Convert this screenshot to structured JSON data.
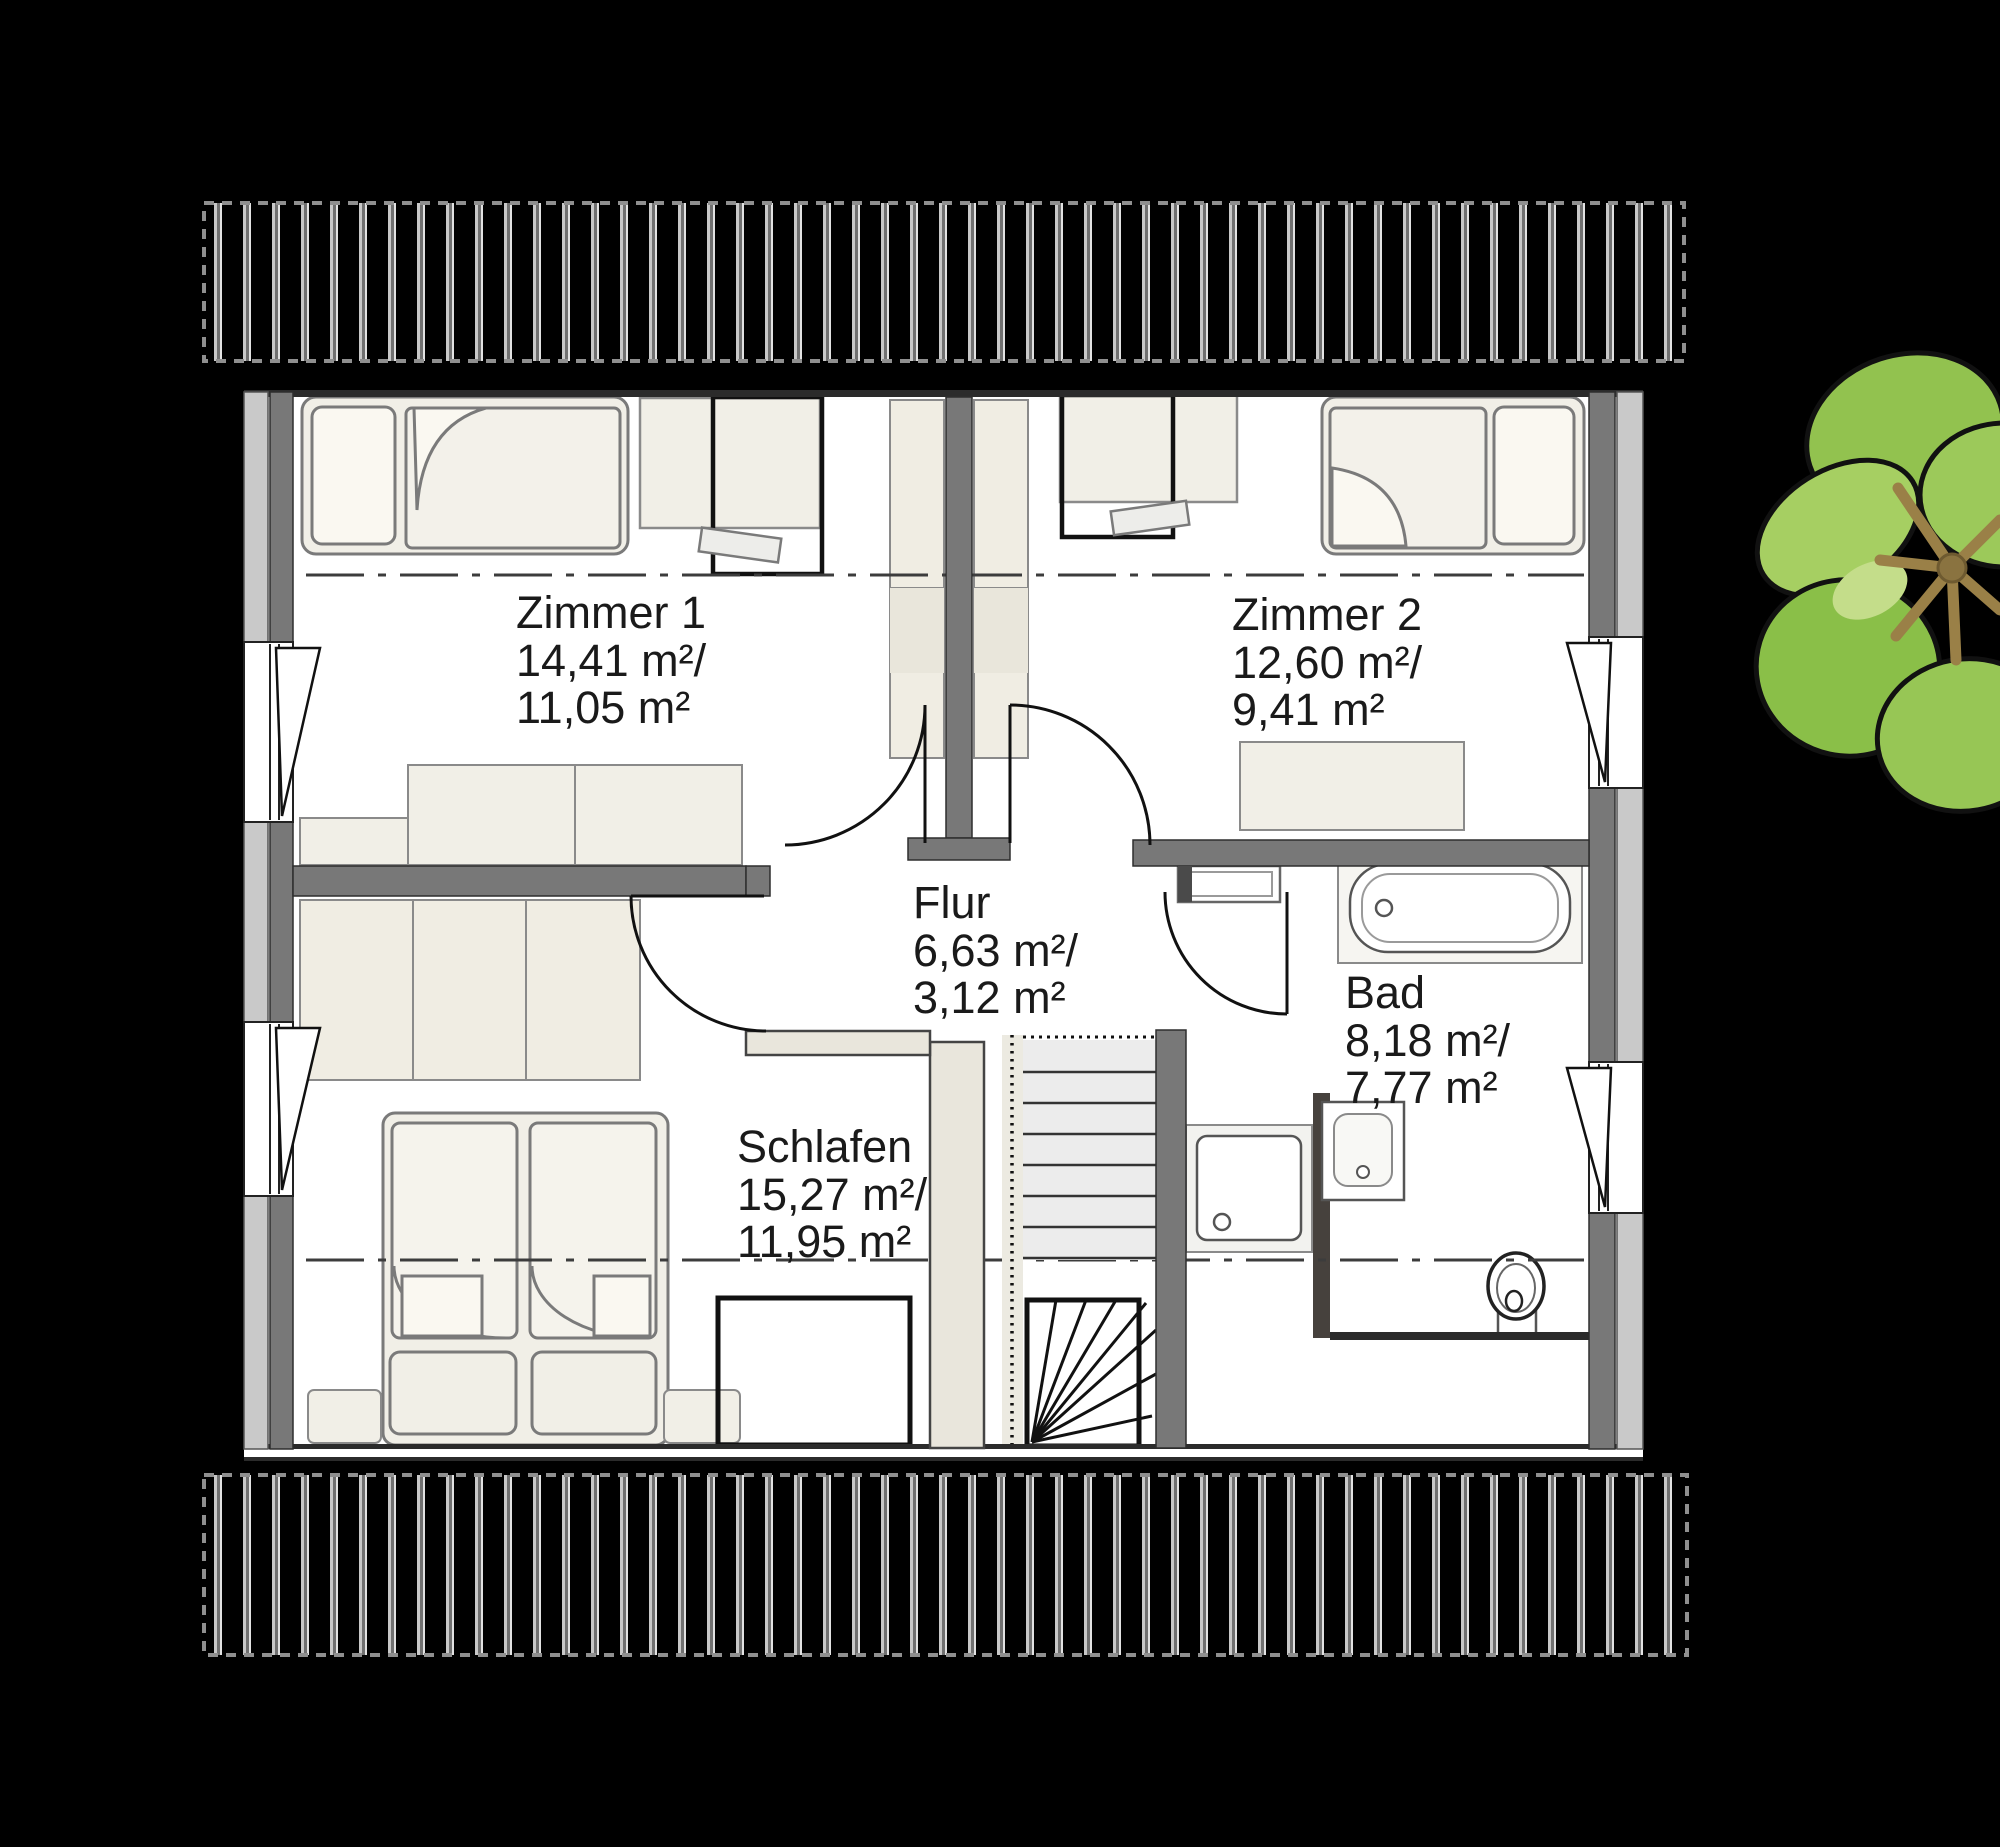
{
  "floorplan": {
    "rooms": [
      {
        "id": "zimmer1",
        "name": "Zimmer 1",
        "gross_area": "14,41 m²/",
        "living_area": "11,05 m²"
      },
      {
        "id": "zimmer2",
        "name": "Zimmer 2",
        "gross_area": "12,60 m²/",
        "living_area": "9,41 m²"
      },
      {
        "id": "flur",
        "name": "Flur",
        "gross_area": "6,63 m²/",
        "living_area": "3,12 m²"
      },
      {
        "id": "bad",
        "name": "Bad",
        "gross_area": "8,18 m²/",
        "living_area": "7,77 m²"
      },
      {
        "id": "schlafen",
        "name": "Schlafen",
        "gross_area": "15,27 m²/",
        "living_area": "11,95 m²"
      }
    ],
    "colors": {
      "background": "#000000",
      "floor": "#ffffff",
      "wall_dark": "#757575",
      "wall_light": "#c9c9c9",
      "furniture": "#f1efe7",
      "roof_hatch_bar": "#c8c8c8",
      "plant_green": "#8fc04c",
      "plant_branch": "#9a8047",
      "text": "#1a1a1a"
    }
  }
}
